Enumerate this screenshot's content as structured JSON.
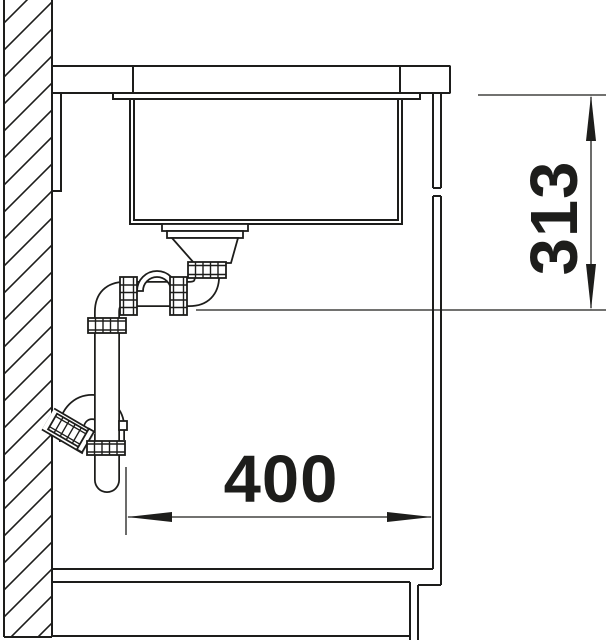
{
  "drawing": {
    "title": "sink-cabinet-cross-section",
    "dimensions": [
      {
        "id": "vertical-depth",
        "value": "313",
        "orientation": "vertical"
      },
      {
        "id": "horizontal-clearance",
        "value": "400",
        "orientation": "horizontal"
      }
    ],
    "colors": {
      "line": "#1d1d1b",
      "background": "#ffffff"
    }
  }
}
